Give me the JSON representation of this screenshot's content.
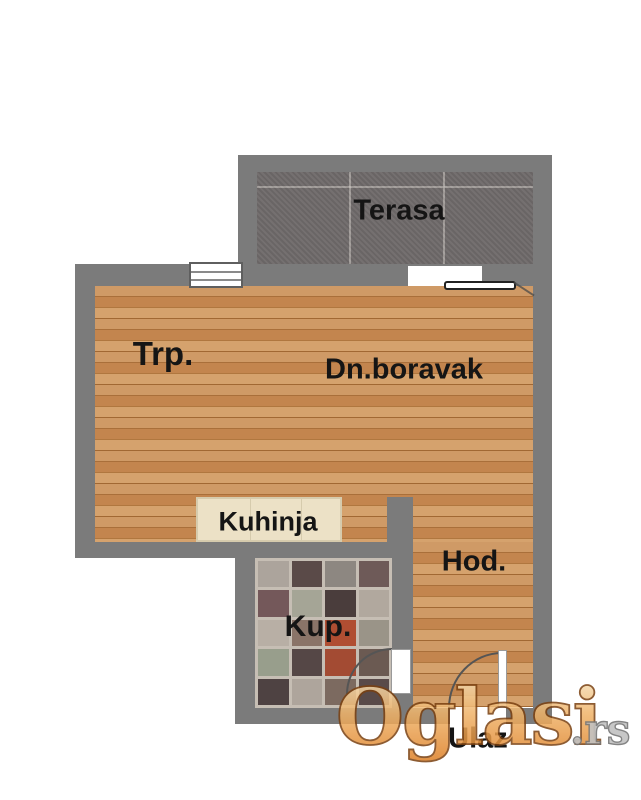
{
  "plan": {
    "title": "apartment-floor-plan",
    "rooms": {
      "terasa": {
        "label": "Terasa"
      },
      "trpezarija": {
        "label": "Trp."
      },
      "dnevni_boravak": {
        "label": "Dn.boravak"
      },
      "kuhinja": {
        "label": "Kuhinja"
      },
      "hodnik": {
        "label": "Hod."
      },
      "kupatilo": {
        "label": "Kup."
      },
      "ulaz": {
        "label": "Ulaz"
      }
    },
    "colors": {
      "wall": "#7b7b7b",
      "wood_base": "#c68e58",
      "terrace_base": "#6f6a6a",
      "counter": "#ece1c6",
      "label_text": "#151515"
    },
    "bath_tile_colors": [
      "#aca49c",
      "#5a4a48",
      "#8d8781",
      "#6e5a58",
      "#74585a",
      "#a5a596",
      "#4a3d3c",
      "#b1a89e",
      "#b8afa5",
      "#8a7468",
      "#b04e32",
      "#9a9488",
      "#989e8c",
      "#554746",
      "#a34b33",
      "#6b5a52",
      "#4e4242",
      "#aea59c",
      "#7c6a60",
      "#594a49"
    ]
  },
  "watermark": {
    "brand": "Oglasi",
    "tld": ".rs",
    "orange_light": "#f7e9c9",
    "orange_mid": "#f0b46a",
    "orange_dark": "#dd7d22",
    "outline": "#7a4010",
    "gray_fill": "#c2c2c2",
    "gray_outline": "#777777"
  }
}
